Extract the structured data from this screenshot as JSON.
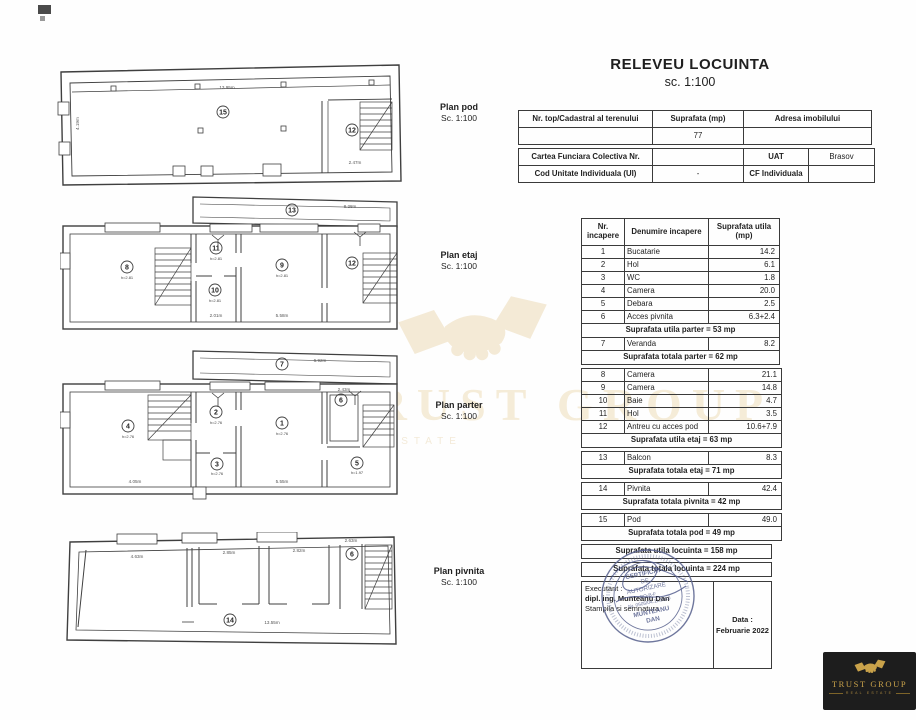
{
  "title": {
    "text": "RELEVEU LOCUINTA",
    "scale": "sc. 1:100"
  },
  "info_table": {
    "r1c1": "Nr. top/Cadastral al terenului",
    "r1c2": "Suprafata (mp)",
    "r1c3": "Adresa imobilului",
    "r2c2": "77",
    "r3c1": "Cartea Funciara Colectiva Nr.",
    "r3c3a": "UAT",
    "r3c3b": "Brasov",
    "r4c1": "Cod Unitate Individuala (UI)",
    "r4c2": "-",
    "r4c3a": "CF Individuala",
    "r4c3b": ""
  },
  "room_table": {
    "headers": [
      "Nr. incapere",
      "Denumire incapere",
      "Suprafata utila (mp)"
    ],
    "rows": [
      {
        "nr": "1",
        "name": "Bucatarie",
        "area": "14.2"
      },
      {
        "nr": "2",
        "name": "Hol",
        "area": "6.1"
      },
      {
        "nr": "3",
        "name": "WC",
        "area": "1.8"
      },
      {
        "nr": "4",
        "name": "Camera",
        "area": "20.0"
      },
      {
        "nr": "5",
        "name": "Debara",
        "area": "2.5"
      },
      {
        "nr": "6",
        "name": "Acces pivnita",
        "area": "6.3+2.4"
      },
      {
        "nr": "7",
        "name": "Veranda",
        "area": "8.2"
      },
      {
        "nr": "8",
        "name": "Camera",
        "area": "21.1"
      },
      {
        "nr": "9",
        "name": "Camera",
        "area": "14.8"
      },
      {
        "nr": "10",
        "name": "Baie",
        "area": "4.7"
      },
      {
        "nr": "11",
        "name": "Hol",
        "area": "3.5"
      },
      {
        "nr": "12",
        "name": "Antreu cu acces pod",
        "area": "10.6+7.9"
      },
      {
        "nr": "13",
        "name": "Balcon",
        "area": "8.3"
      },
      {
        "nr": "14",
        "name": "Pivnita",
        "area": "42.4"
      },
      {
        "nr": "15",
        "name": "Pod",
        "area": "49.0"
      }
    ],
    "summary": {
      "utila_parter": "Suprafata utila parter = 53 mp",
      "totala_parter": "Suprafata totala parter = 62 mp",
      "utila_etaj": "Suprafata utila etaj = 63 mp",
      "totala_etaj": "Suprafata totala etaj = 71 mp",
      "totala_pivnita": "Suprafata totala pivnita = 42 mp",
      "totala_pod": "Suprafata totala pod = 49 mp",
      "utila_locuinta": "Suprafata utila locuinta = 158 mp",
      "totala_locuinta": "Suprafata totala locuinta = 224 mp"
    }
  },
  "plans": [
    {
      "label": "Plan pod",
      "scale": "Sc. 1:100",
      "rooms": [
        "15",
        "12"
      ],
      "dims": [
        "13.95m",
        "4.19m",
        "2.47m"
      ]
    },
    {
      "label": "Plan etaj",
      "scale": "Sc. 1:100",
      "rooms": [
        "13",
        "8",
        "11",
        "10",
        "9",
        "12"
      ],
      "height_label": "h=2.81",
      "dims": [
        "8.28m",
        "2.01m",
        "5.58m"
      ]
    },
    {
      "label": "Plan parter",
      "scale": "Sc. 1:100",
      "rooms": [
        "7",
        "4",
        "2",
        "3",
        "1",
        "6",
        "5"
      ],
      "height_label": "h=2.76",
      "height_label_small": "h=1.97",
      "dims": [
        "6.92m",
        "4.05m",
        "5.55m",
        "2.43m"
      ]
    },
    {
      "label": "Plan pivnita",
      "scale": "Sc. 1:100",
      "rooms": [
        "14",
        "6"
      ],
      "dims": [
        "4.63m",
        "2.85m",
        "2.82m",
        "2.63m",
        "13.55m"
      ]
    }
  ],
  "executant": {
    "label": "Executant :",
    "name": "dipl. ing. Munteanu Dan",
    "note": "Stampila si semnatura"
  },
  "date": {
    "label": "Data :",
    "value": "Februarie 2022"
  },
  "stamp": {
    "line1": "CERTIFICAT",
    "line2": "DE",
    "line3": "AUTORIZARE",
    "line4": "RO-B-F",
    "line5": "Nr. 0505/04.11.2010",
    "line6": "MUNTEANU",
    "line7": "DAN"
  },
  "watermark": {
    "text": "TRUST GROUP",
    "subtext": "REAL ESTATE"
  },
  "logo": {
    "title": "TRUST GROUP",
    "subtitle": "REAL ESTATE"
  },
  "colors": {
    "stamp_ink": "#5c6590",
    "watermark_gold": "#f5ecd8",
    "logo_gold": "#c9a24a",
    "logo_bg": "#1d1d1d",
    "line": "#3a3a3a"
  }
}
